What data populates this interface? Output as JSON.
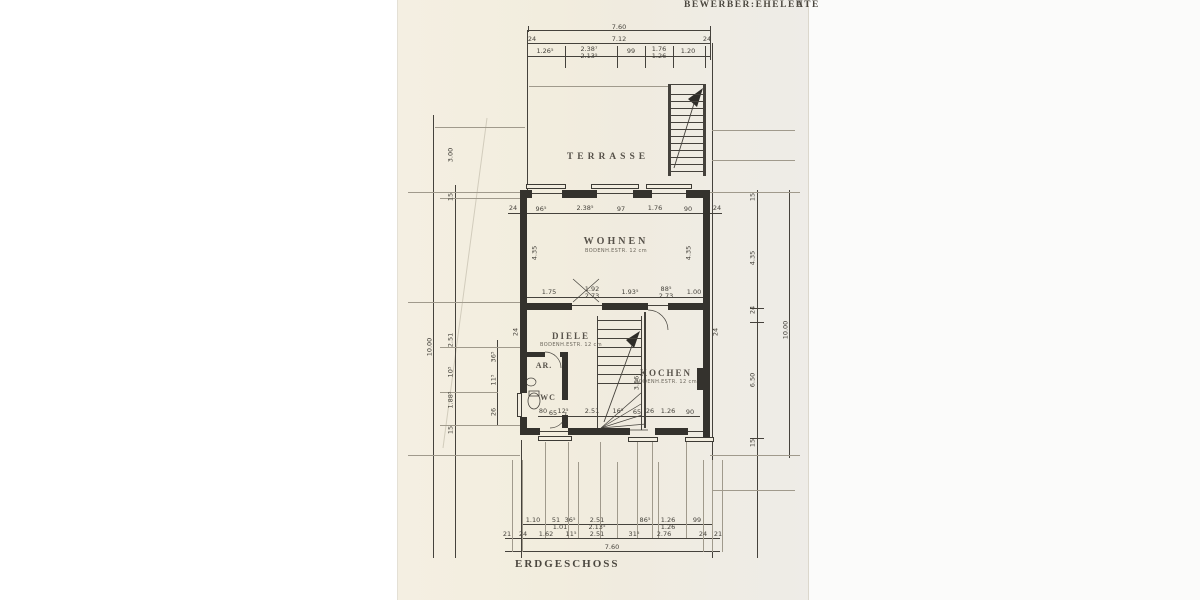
{
  "header": {
    "applicant": "BEWERBER:EHELEUTE",
    "mark": "A"
  },
  "footer": {
    "floor": "ERDGESCHOSS"
  },
  "rooms": {
    "terrasse": "TERRASSE",
    "wohnen": "WOHNEN",
    "diele": "DIELE",
    "kochen": "KOCHEN",
    "ar": "AR.",
    "wc": "WC",
    "floor_note": "BODENH.ESTR. 12 cm"
  },
  "dims": {
    "top_total": "7.60",
    "top_row2": [
      "24",
      "7.12",
      "24"
    ],
    "top_row3": [
      "1.26⁵",
      "2.38⁷",
      "2.13⁵",
      "99",
      "1.76",
      "1.26",
      "1.20"
    ],
    "wall_row": [
      "24",
      "96⁵",
      "2.38⁵",
      "97",
      "1.76",
      "90",
      "24"
    ],
    "mid_row": [
      "1.75",
      "1.92",
      "2.73",
      "1.93⁵",
      "88⁵",
      "2.73",
      "1.00"
    ],
    "inner_row": [
      "80",
      "65",
      "12⁵",
      "2.51",
      "16⁵",
      "65",
      "26",
      "1.26",
      "90"
    ],
    "bottom_row1": [
      "1.10",
      "51",
      "1.01",
      "36⁵",
      "2.51",
      "2.13⁵",
      "86⁵",
      "1.26",
      "1.26",
      "99"
    ],
    "bottom_row2": [
      "21",
      "24",
      "1.62",
      "11⁵",
      "2.51",
      "31⁵",
      "2.76",
      "24",
      "21"
    ],
    "bottom_total": "7.60",
    "left_col": [
      "3.00",
      "15",
      "10.00",
      "2.51",
      "10⁵",
      "1.88⁵",
      "15",
      "36⁵",
      "11⁵",
      "26",
      "24"
    ],
    "right_col": [
      "15",
      "4.35",
      "24",
      "6.50",
      "15",
      "10.00",
      "24"
    ],
    "room_dims": [
      "4.35",
      "4.35",
      "3.56"
    ]
  },
  "colors": {
    "line": "#45423c",
    "paper": "#f1ecdf",
    "ink_label": "#57524a"
  }
}
